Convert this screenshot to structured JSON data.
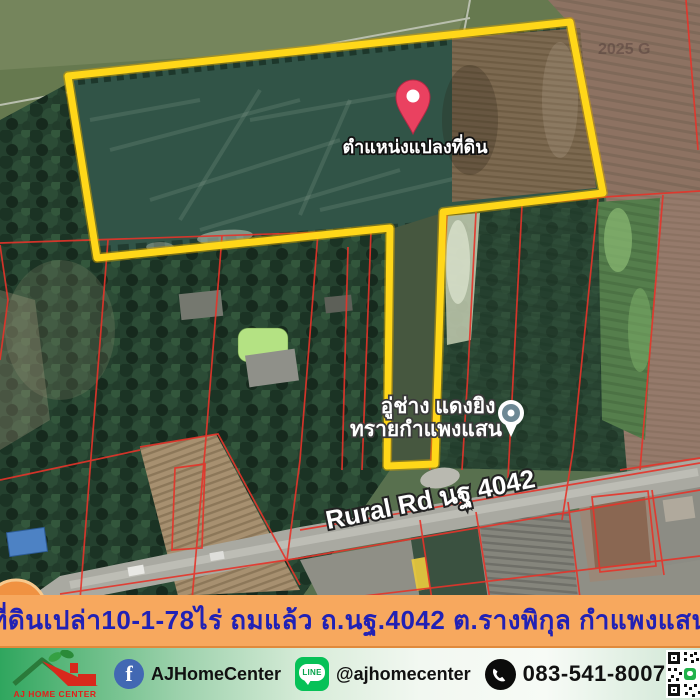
{
  "map": {
    "watermark": "2025 G",
    "pin": {
      "label": "ตำแหน่งแปลงที่ดิน",
      "color": "#ea4160"
    },
    "poi": {
      "name_line1": "อู่ช่าง แดงยิง",
      "name_line2": "ทรายกำแพงแสน"
    },
    "road": {
      "label": "Rural Rd นฐ 4042"
    },
    "boundary_color": "#ffd719",
    "cadastral_line_color": "#e5342a"
  },
  "banner": {
    "text": "ที่ดินเปล่า10-1-78ไร่ ถมแล้ว ถ.นฐ.4042 ต.รางพิกุล กำแพงแสน",
    "background": "#f7a85e",
    "text_color": "#2121b5"
  },
  "footer": {
    "logo_text": "AJ HOME CENTER",
    "facebook_icon_letter": "f",
    "facebook_label": "AJHomeCenter",
    "line_icon_text": "LINE",
    "line_label": "@ajhomecenter",
    "phone_number": "083-541-8007"
  }
}
